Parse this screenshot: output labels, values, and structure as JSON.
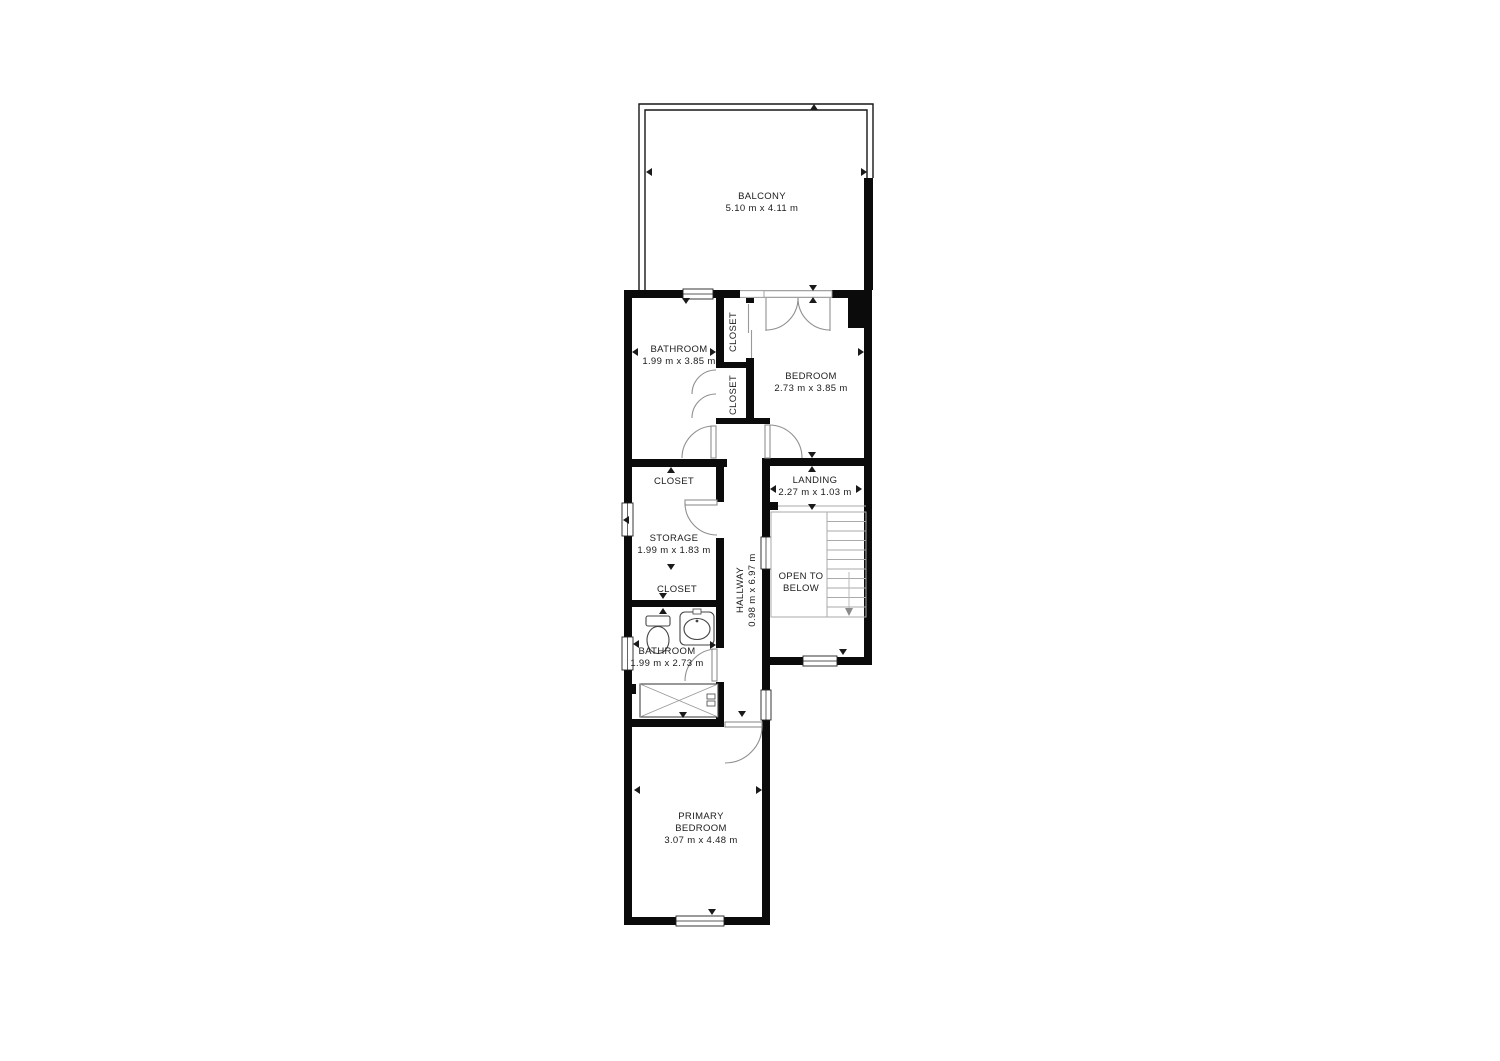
{
  "plan": {
    "title": "Second floor plan",
    "colors": {
      "wall": "#0b0b0b",
      "door_arc": "#8f8f8f",
      "stair_line": "#aaaaaa",
      "fixture_line": "#444444",
      "marker": "#1a1a1a",
      "label_text": "#1c1c1c",
      "background": "#ffffff"
    },
    "rooms": [
      {
        "id": "balcony",
        "label": "BALCONY",
        "dims": "5.10 m x 4.11 m"
      },
      {
        "id": "bathroom-upper",
        "label": "BATHROOM",
        "dims": "1.99 m x 3.85 m"
      },
      {
        "id": "bedroom",
        "label": "BEDROOM",
        "dims": "2.73 m x 3.85 m"
      },
      {
        "id": "closet-bedroom",
        "label": "CLOSET",
        "dims": ""
      },
      {
        "id": "closet-bathroom",
        "label": "CLOSET",
        "dims": ""
      },
      {
        "id": "landing",
        "label": "LANDING",
        "dims": "2.27 m x 1.03 m"
      },
      {
        "id": "closet-top",
        "label": "CLOSET",
        "dims": ""
      },
      {
        "id": "storage",
        "label": "STORAGE",
        "dims": "1.99 m x 1.83 m"
      },
      {
        "id": "closet-bottom",
        "label": "CLOSET",
        "dims": ""
      },
      {
        "id": "hallway",
        "label": "HALLWAY",
        "dims": "0.98 m x 6.97 m"
      },
      {
        "id": "open-to-below",
        "label": "OPEN TO BELOW",
        "dims": ""
      },
      {
        "id": "bathroom-lower",
        "label": "BATHROOM",
        "dims": "1.99 m x 2.73 m"
      },
      {
        "id": "primary-bedroom",
        "label": "PRIMARY BEDROOM",
        "dims": "3.07 m x 4.48 m"
      }
    ],
    "features": {
      "stairs": "stairs-down",
      "fixtures": [
        "toilet",
        "sink",
        "bathtub"
      ]
    }
  }
}
